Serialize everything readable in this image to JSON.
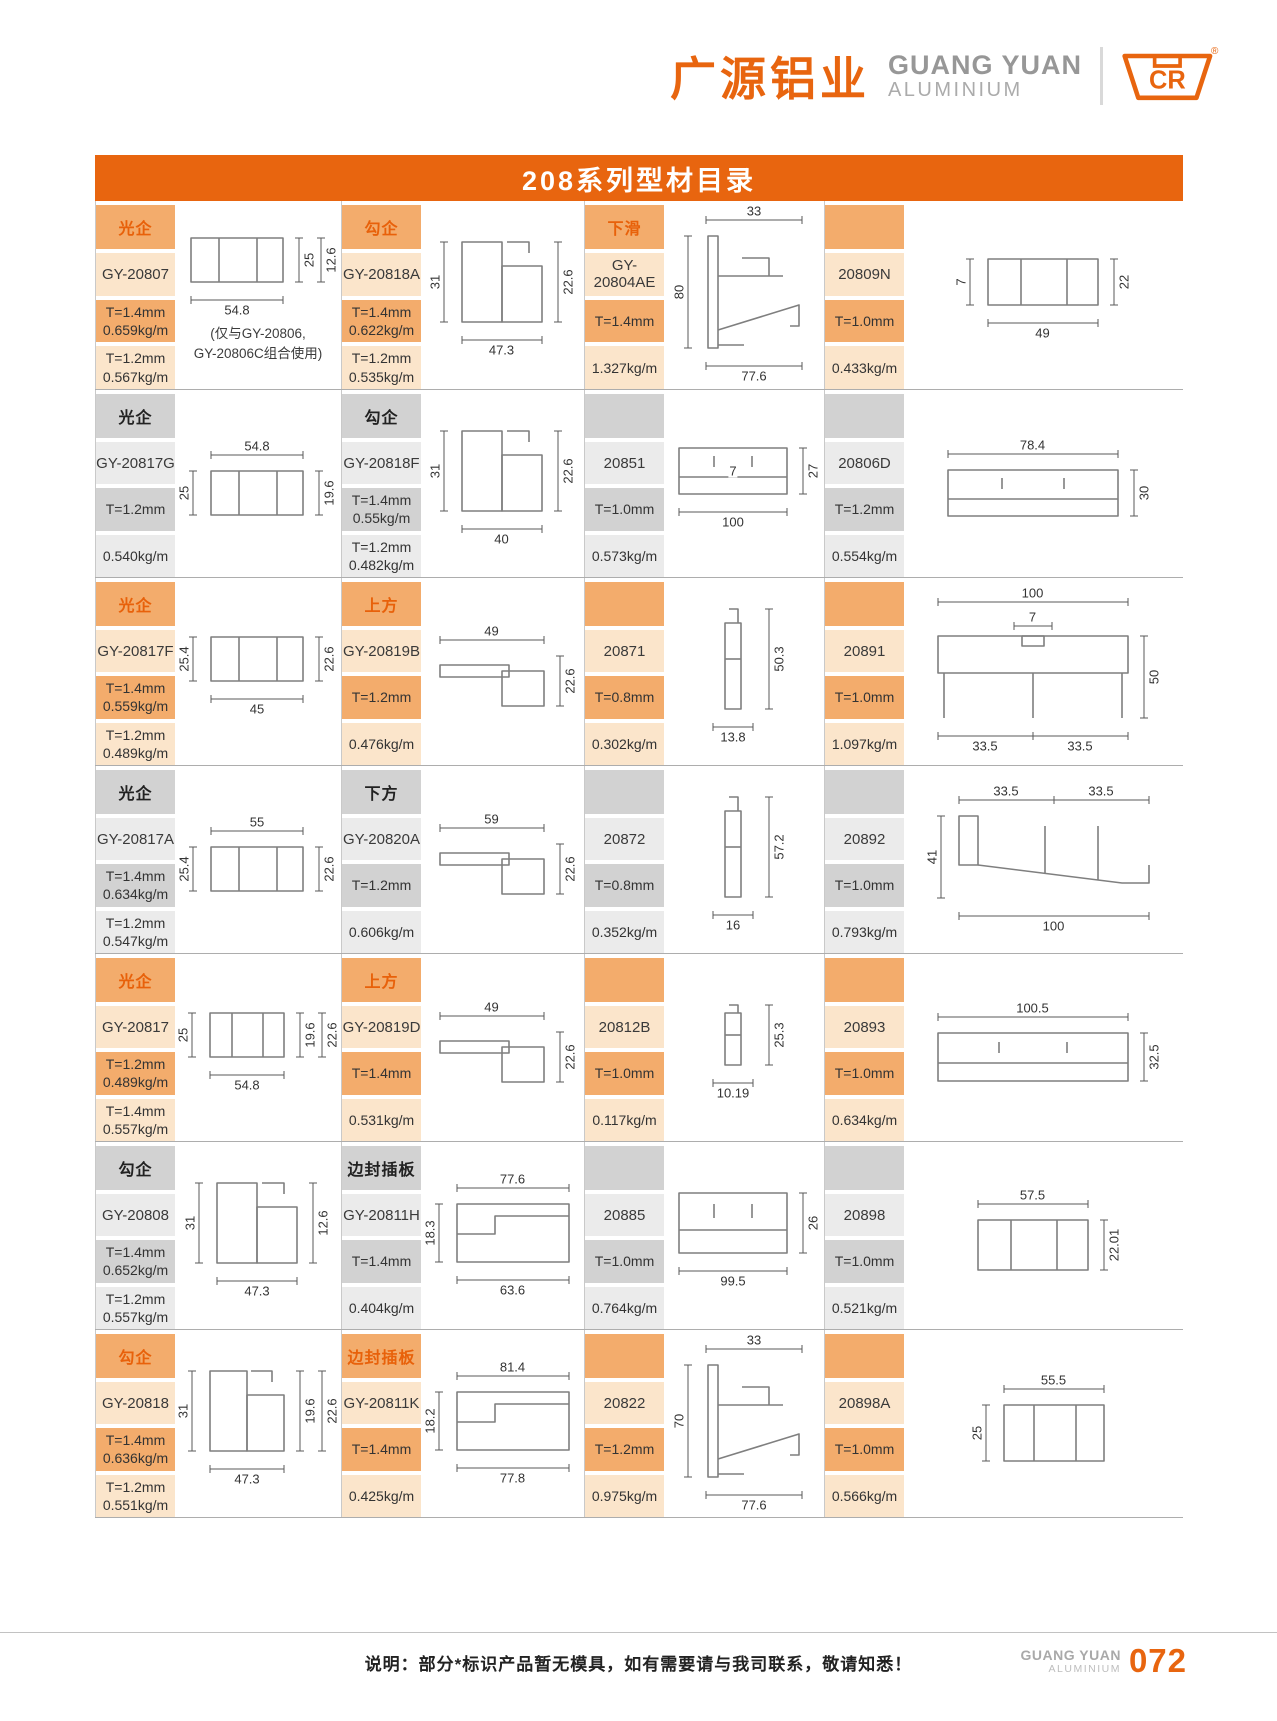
{
  "header": {
    "brand_cn": "广源铝业",
    "brand_en": "GUANG YUAN",
    "brand_sub": "ALUMINIUM",
    "logo_text": "CR",
    "registered": "®"
  },
  "title": "208系列型材目录",
  "footer": {
    "note": "说明：部分*标识产品暂无模具，如有需要请与我司联系，敬请知悉！",
    "brand_en": "GUANG YUAN",
    "brand_sub": "ALUMINIUM",
    "page_number": "072"
  },
  "colors": {
    "accent": "#E8650F",
    "orange_label_bg": "#F3AC6C",
    "orange_light_bg": "#FBE5CB",
    "orange_text": "#E8610A",
    "gray_label_bg": "#D2D2D2",
    "gray_light_bg": "#EBEBEB",
    "row_border": "#ADADAD"
  },
  "table": {
    "rows": [
      {
        "scheme": "orange",
        "entries": [
          {
            "label": "光企",
            "code": "GY-20807",
            "spec1": "T=1.4mm\n0.659kg/m",
            "spec2": "T=1.2mm\n0.567kg/m",
            "note": "(仅与GY-20806,\nGY-20806C组合使用)",
            "drawing": {
              "kind": "rect",
              "w": 92,
              "h": 44,
              "dims": [
                {
                  "v": "12.6",
                  "side": "right2"
                },
                {
                  "v": "25",
                  "side": "right"
                },
                {
                  "v": "54.8",
                  "side": "bottom"
                }
              ]
            }
          },
          {
            "label": "勾企",
            "code": "GY-20818A",
            "spec1": "T=1.4mm\n0.622kg/m",
            "spec2": "T=1.2mm\n0.535kg/m",
            "drawing": {
              "kind": "hook",
              "w": 80,
              "h": 80,
              "dims": [
                {
                  "v": "31",
                  "side": "left"
                },
                {
                  "v": "22.6",
                  "side": "right"
                },
                {
                  "v": "47.3",
                  "side": "bottom"
                }
              ]
            }
          },
          {
            "label": "下滑",
            "code": "GY-20804AE",
            "spec1": "T=1.4mm",
            "spec2": "1.327kg/m",
            "drawing": {
              "kind": "slope",
              "w": 96,
              "h": 112,
              "dims": [
                {
                  "v": "33",
                  "side": "top"
                },
                {
                  "v": "80",
                  "side": "left"
                },
                {
                  "v": "77.6",
                  "side": "bottom"
                }
              ]
            }
          },
          {
            "label": "",
            "code": "20809N",
            "spec1": "T=1.0mm",
            "spec2": "0.433kg/m",
            "drawing": {
              "kind": "rect",
              "w": 110,
              "h": 46,
              "dims": [
                {
                  "v": "7",
                  "side": "left"
                },
                {
                  "v": "22",
                  "side": "right"
                },
                {
                  "v": "49",
                  "side": "bottom"
                }
              ]
            }
          }
        ]
      },
      {
        "scheme": "gray",
        "entries": [
          {
            "label": "光企",
            "code": "GY-20817G",
            "spec1": "T=1.2mm",
            "spec2": "0.540kg/m",
            "drawing": {
              "kind": "rect",
              "w": 92,
              "h": 44,
              "dims": [
                {
                  "v": "54.8",
                  "side": "top"
                },
                {
                  "v": "25",
                  "side": "left"
                },
                {
                  "v": "19.6",
                  "side": "right"
                }
              ]
            }
          },
          {
            "label": "勾企",
            "code": "GY-20818F",
            "spec1": "T=1.4mm\n0.55kg/m",
            "spec2": "T=1.2mm\n0.482kg/m",
            "drawing": {
              "kind": "hook",
              "w": 80,
              "h": 80,
              "dims": [
                {
                  "v": "31",
                  "side": "left"
                },
                {
                  "v": "22.6",
                  "side": "right"
                },
                {
                  "v": "40",
                  "side": "bottom"
                }
              ]
            }
          },
          {
            "label": "",
            "code": "20851",
            "spec1": "T=1.0mm",
            "spec2": "0.573kg/m",
            "drawing": {
              "kind": "channel",
              "w": 108,
              "h": 46,
              "dims": [
                {
                  "v": "27",
                  "side": "right"
                },
                {
                  "v": "7",
                  "side": "inner"
                },
                {
                  "v": "100",
                  "side": "bottom"
                }
              ]
            }
          },
          {
            "label": "",
            "code": "20806D",
            "spec1": "T=1.2mm",
            "spec2": "0.554kg/m",
            "drawing": {
              "kind": "channel",
              "w": 170,
              "h": 46,
              "dims": [
                {
                  "v": "78.4",
                  "side": "top"
                },
                {
                  "v": "30",
                  "side": "right"
                }
              ]
            }
          }
        ]
      },
      {
        "scheme": "orange",
        "entries": [
          {
            "label": "光企",
            "code": "GY-20817F",
            "spec1": "T=1.4mm\n0.559kg/m",
            "spec2": "T=1.2mm\n0.489kg/m",
            "drawing": {
              "kind": "rect",
              "w": 92,
              "h": 44,
              "dims": [
                {
                  "v": "25.4",
                  "side": "left"
                },
                {
                  "v": "22.6",
                  "side": "right"
                },
                {
                  "v": "45",
                  "side": "bottom"
                }
              ]
            }
          },
          {
            "label": "上方",
            "code": "GY-20819B",
            "spec1": "T=1.2mm",
            "spec2": "0.476kg/m",
            "drawing": {
              "kind": "flatstep",
              "w": 104,
              "h": 50,
              "dims": [
                {
                  "v": "49",
                  "side": "top"
                },
                {
                  "v": "22.6",
                  "side": "right"
                }
              ]
            }
          },
          {
            "label": "",
            "code": "20871",
            "spec1": "T=0.8mm",
            "spec2": "0.302kg/m",
            "drawing": {
              "kind": "clip",
              "w": 40,
              "h": 100,
              "dims": [
                {
                  "v": "50.3",
                  "side": "right"
                },
                {
                  "v": "13.8",
                  "side": "bottom"
                }
              ]
            }
          },
          {
            "label": "",
            "code": "20891",
            "spec1": "T=1.0mm",
            "spec2": "1.097kg/m",
            "drawing": {
              "kind": "channeltall",
              "w": 190,
              "h": 82,
              "dims": [
                {
                  "v": "100",
                  "side": "top"
                },
                {
                  "v": "7",
                  "side": "top2"
                },
                {
                  "v": "50",
                  "side": "right"
                },
                {
                  "v": "33.5",
                  "side": "bottom"
                },
                {
                  "v": "33.5",
                  "side": "bottom"
                }
              ]
            }
          }
        ]
      },
      {
        "scheme": "gray",
        "entries": [
          {
            "label": "光企",
            "code": "GY-20817A",
            "spec1": "T=1.4mm\n0.634kg/m",
            "spec2": "T=1.2mm\n0.547kg/m",
            "drawing": {
              "kind": "rect",
              "w": 92,
              "h": 44,
              "dims": [
                {
                  "v": "55",
                  "side": "top"
                },
                {
                  "v": "25.4",
                  "side": "left"
                },
                {
                  "v": "22.6",
                  "side": "right"
                }
              ]
            }
          },
          {
            "label": "下方",
            "code": "GY-20820A",
            "spec1": "T=1.2mm",
            "spec2": "0.606kg/m",
            "drawing": {
              "kind": "flatstep",
              "w": 104,
              "h": 50,
              "dims": [
                {
                  "v": "59",
                  "side": "top"
                },
                {
                  "v": "22.6",
                  "side": "right"
                }
              ]
            }
          },
          {
            "label": "",
            "code": "20872",
            "spec1": "T=0.8mm",
            "spec2": "0.352kg/m",
            "drawing": {
              "kind": "clip",
              "w": 40,
              "h": 100,
              "dims": [
                {
                  "v": "57.2",
                  "side": "right"
                },
                {
                  "v": "16",
                  "side": "bottom"
                }
              ]
            }
          },
          {
            "label": "",
            "code": "20892",
            "spec1": "T=1.0mm",
            "spec2": "0.793kg/m",
            "drawing": {
              "kind": "slopewide",
              "w": 190,
              "h": 82,
              "dims": [
                {
                  "v": "33.5",
                  "side": "top"
                },
                {
                  "v": "33.5",
                  "side": "top"
                },
                {
                  "v": "41",
                  "side": "left"
                },
                {
                  "v": "100",
                  "side": "bottom"
                }
              ]
            }
          }
        ]
      },
      {
        "scheme": "orange",
        "entries": [
          {
            "label": "光企",
            "code": "GY-20817",
            "spec1": "T=1.2mm\n0.489kg/m",
            "spec2": "T=1.4mm\n0.557kg/m",
            "drawing": {
              "kind": "rect",
              "w": 74,
              "h": 44,
              "dims": [
                {
                  "v": "25",
                  "side": "left"
                },
                {
                  "v": "19.6",
                  "side": "right"
                },
                {
                  "v": "22.6",
                  "side": "right2"
                },
                {
                  "v": "54.8",
                  "side": "bottom"
                }
              ]
            }
          },
          {
            "label": "上方",
            "code": "GY-20819D",
            "spec1": "T=1.4mm",
            "spec2": "0.531kg/m",
            "drawing": {
              "kind": "flatstep",
              "w": 104,
              "h": 50,
              "dims": [
                {
                  "v": "49",
                  "side": "top"
                },
                {
                  "v": "22.6",
                  "side": "right"
                }
              ]
            }
          },
          {
            "label": "",
            "code": "20812B",
            "spec1": "T=1.0mm",
            "spec2": "0.117kg/m",
            "drawing": {
              "kind": "clip",
              "w": 40,
              "h": 60,
              "dims": [
                {
                  "v": "25.3",
                  "side": "right"
                },
                {
                  "v": "10.19",
                  "side": "bottom"
                }
              ]
            }
          },
          {
            "label": "",
            "code": "20893",
            "spec1": "T=1.0mm",
            "spec2": "0.634kg/m",
            "drawing": {
              "kind": "channel",
              "w": 190,
              "h": 48,
              "dims": [
                {
                  "v": "100.5",
                  "side": "top"
                },
                {
                  "v": "32.5",
                  "side": "right"
                }
              ]
            }
          }
        ]
      },
      {
        "scheme": "gray",
        "entries": [
          {
            "label": "勾企",
            "code": "GY-20808",
            "spec1": "T=1.4mm\n0.652kg/m",
            "spec2": "T=1.2mm\n0.557kg/m",
            "drawing": {
              "kind": "hook",
              "w": 80,
              "h": 80,
              "dims": [
                {
                  "v": "31",
                  "side": "left"
                },
                {
                  "v": "12.6",
                  "side": "right"
                },
                {
                  "v": "47.3",
                  "side": "bottom"
                }
              ]
            }
          },
          {
            "label": "边封插板",
            "code": "GY-20811H",
            "spec1": "T=1.4mm",
            "spec2": "0.404kg/m",
            "drawing": {
              "kind": "steprect",
              "w": 112,
              "h": 58,
              "dims": [
                {
                  "v": "77.6",
                  "side": "top"
                },
                {
                  "v": "18.3",
                  "side": "left"
                },
                {
                  "v": "63.6",
                  "side": "bottom"
                }
              ]
            }
          },
          {
            "label": "",
            "code": "20885",
            "spec1": "T=1.0mm",
            "spec2": "0.764kg/m",
            "drawing": {
              "kind": "channel",
              "w": 108,
              "h": 60,
              "dims": [
                {
                  "v": "26",
                  "side": "right"
                },
                {
                  "v": "99.5",
                  "side": "bottom"
                }
              ]
            }
          },
          {
            "label": "",
            "code": "20898",
            "spec1": "T=1.0mm",
            "spec2": "0.521kg/m",
            "drawing": {
              "kind": "rect",
              "w": 110,
              "h": 50,
              "dims": [
                {
                  "v": "57.5",
                  "side": "top"
                },
                {
                  "v": "22.01",
                  "side": "right"
                }
              ]
            }
          }
        ]
      },
      {
        "scheme": "orange",
        "entries": [
          {
            "label": "勾企",
            "code": "GY-20818",
            "spec1": "T=1.4mm\n0.636kg/m",
            "spec2": "T=1.2mm\n0.551kg/m",
            "drawing": {
              "kind": "hook",
              "w": 74,
              "h": 80,
              "dims": [
                {
                  "v": "31",
                  "side": "left"
                },
                {
                  "v": "19.6",
                  "side": "right"
                },
                {
                  "v": "22.6",
                  "side": "right2"
                },
                {
                  "v": "47.3",
                  "side": "bottom"
                }
              ]
            }
          },
          {
            "label": "边封插板",
            "code": "GY-20811K",
            "spec1": "T=1.4mm",
            "spec2": "0.425kg/m",
            "drawing": {
              "kind": "steprect",
              "w": 112,
              "h": 58,
              "dims": [
                {
                  "v": "81.4",
                  "side": "top"
                },
                {
                  "v": "18.2",
                  "side": "left"
                },
                {
                  "v": "77.8",
                  "side": "bottom"
                }
              ]
            }
          },
          {
            "label": "",
            "code": "20822",
            "spec1": "T=1.2mm",
            "spec2": "0.975kg/m",
            "drawing": {
              "kind": "slope",
              "w": 96,
              "h": 112,
              "dims": [
                {
                  "v": "33",
                  "side": "top"
                },
                {
                  "v": "70",
                  "side": "left"
                },
                {
                  "v": "77.6",
                  "side": "bottom"
                }
              ]
            }
          },
          {
            "label": "",
            "code": "20898A",
            "spec1": "T=1.0mm",
            "spec2": "0.566kg/m",
            "drawing": {
              "kind": "rect",
              "w": 100,
              "h": 56,
              "dims": [
                {
                  "v": "55.5",
                  "side": "top"
                },
                {
                  "v": "25",
                  "side": "left"
                }
              ]
            }
          }
        ]
      }
    ]
  }
}
